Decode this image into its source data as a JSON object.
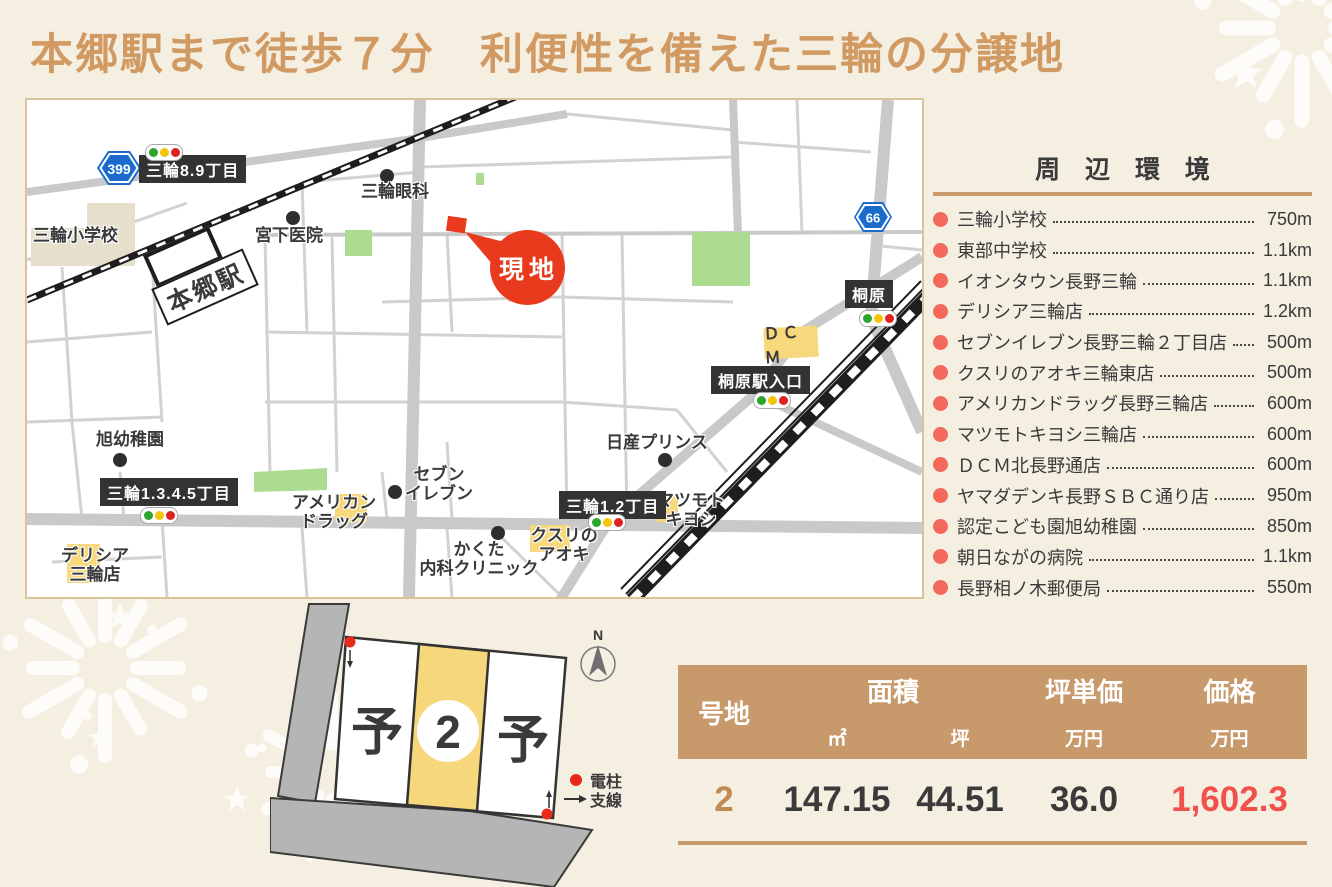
{
  "page": {
    "title": "本郷駅まで徒歩７分　利便性を備えた三輪の分譲地"
  },
  "map": {
    "site_marker": "現地",
    "station": "本郷駅",
    "route_badges": {
      "r399": "399",
      "r66": "66"
    },
    "area_labels": {
      "miwa89": "三輪8.9丁目",
      "kirihara": "桐原",
      "kirihara_eki": "桐原駅入口",
      "miwa1345": "三輪1.3.4.5丁目",
      "miwa12": "三輪1.2丁目"
    },
    "pois": {
      "miwa_elementary": "三輪小学校",
      "miyashita": "宮下医院",
      "miwa_ganka": "三輪眼科",
      "asahi_kindergarten": "旭幼稚園",
      "seven1": "セブン",
      "seven2": "イレブン",
      "nissan": "日産プリンス",
      "kakuta1": "かくた",
      "kakuta2": "内科クリニック",
      "american1": "アメリカン",
      "american2": "ドラッグ",
      "delicia1": "デリシア",
      "delicia2": "三輪店",
      "matsumoto1": "マツモト",
      "matsumoto2": "キヨシ",
      "kusuri1": "クスリの",
      "kusuri2": "アオキ",
      "dcm": "ＤＣＭ"
    }
  },
  "surroundings": {
    "heading": "周 辺 環 境",
    "items": [
      {
        "name": "三輪小学校",
        "distance": "750m"
      },
      {
        "name": "東部中学校",
        "distance": "1.1km"
      },
      {
        "name": "イオンタウン長野三輪",
        "distance": "1.1km"
      },
      {
        "name": "デリシア三輪店",
        "distance": "1.2km"
      },
      {
        "name": "セブンイレブン長野三輪２丁目店",
        "distance": "500m"
      },
      {
        "name": "クスリのアオキ三輪東店",
        "distance": "500m"
      },
      {
        "name": "アメリカンドラッグ長野三輪店",
        "distance": "600m"
      },
      {
        "name": "マツモトキヨシ三輪店",
        "distance": "600m"
      },
      {
        "name": "ＤＣＭ北長野通店",
        "distance": "600m"
      },
      {
        "name": "ヤマダデンキ長野ＳＢＣ通り店",
        "distance": "950m"
      },
      {
        "name": "認定こども園旭幼稚園",
        "distance": "850m"
      },
      {
        "name": "朝日ながの病院",
        "distance": "1.1km"
      },
      {
        "name": "長野相ノ木郵便局",
        "distance": "550m"
      }
    ]
  },
  "lot_plan": {
    "lot_number": "2",
    "reserved_left": "予",
    "reserved_right": "予",
    "compass": "N",
    "legend_pole": "電柱",
    "legend_wire": "支線"
  },
  "price_table": {
    "col_lot": "号地",
    "col_area": "面積",
    "col_unit_price": "坪単価",
    "col_price": "価格",
    "sub_sqm": "㎡",
    "sub_tsubo": "坪",
    "sub_man_yen_unit": "万円",
    "sub_man_yen_price": "万円",
    "row": {
      "lot": "2",
      "sqm": "147.15",
      "tsubo": "44.51",
      "unit_price": "36.0",
      "price": "1,602.3"
    }
  },
  "colors": {
    "background": "#f5efe2",
    "accent_tan": "#c7996b",
    "title_tan": "#d19a62",
    "bullet_red": "#f5695c",
    "price_red": "#f0514a",
    "site_red": "#e93a1d",
    "map_yellow": "#f8d87d",
    "map_green": "#abdc92"
  }
}
